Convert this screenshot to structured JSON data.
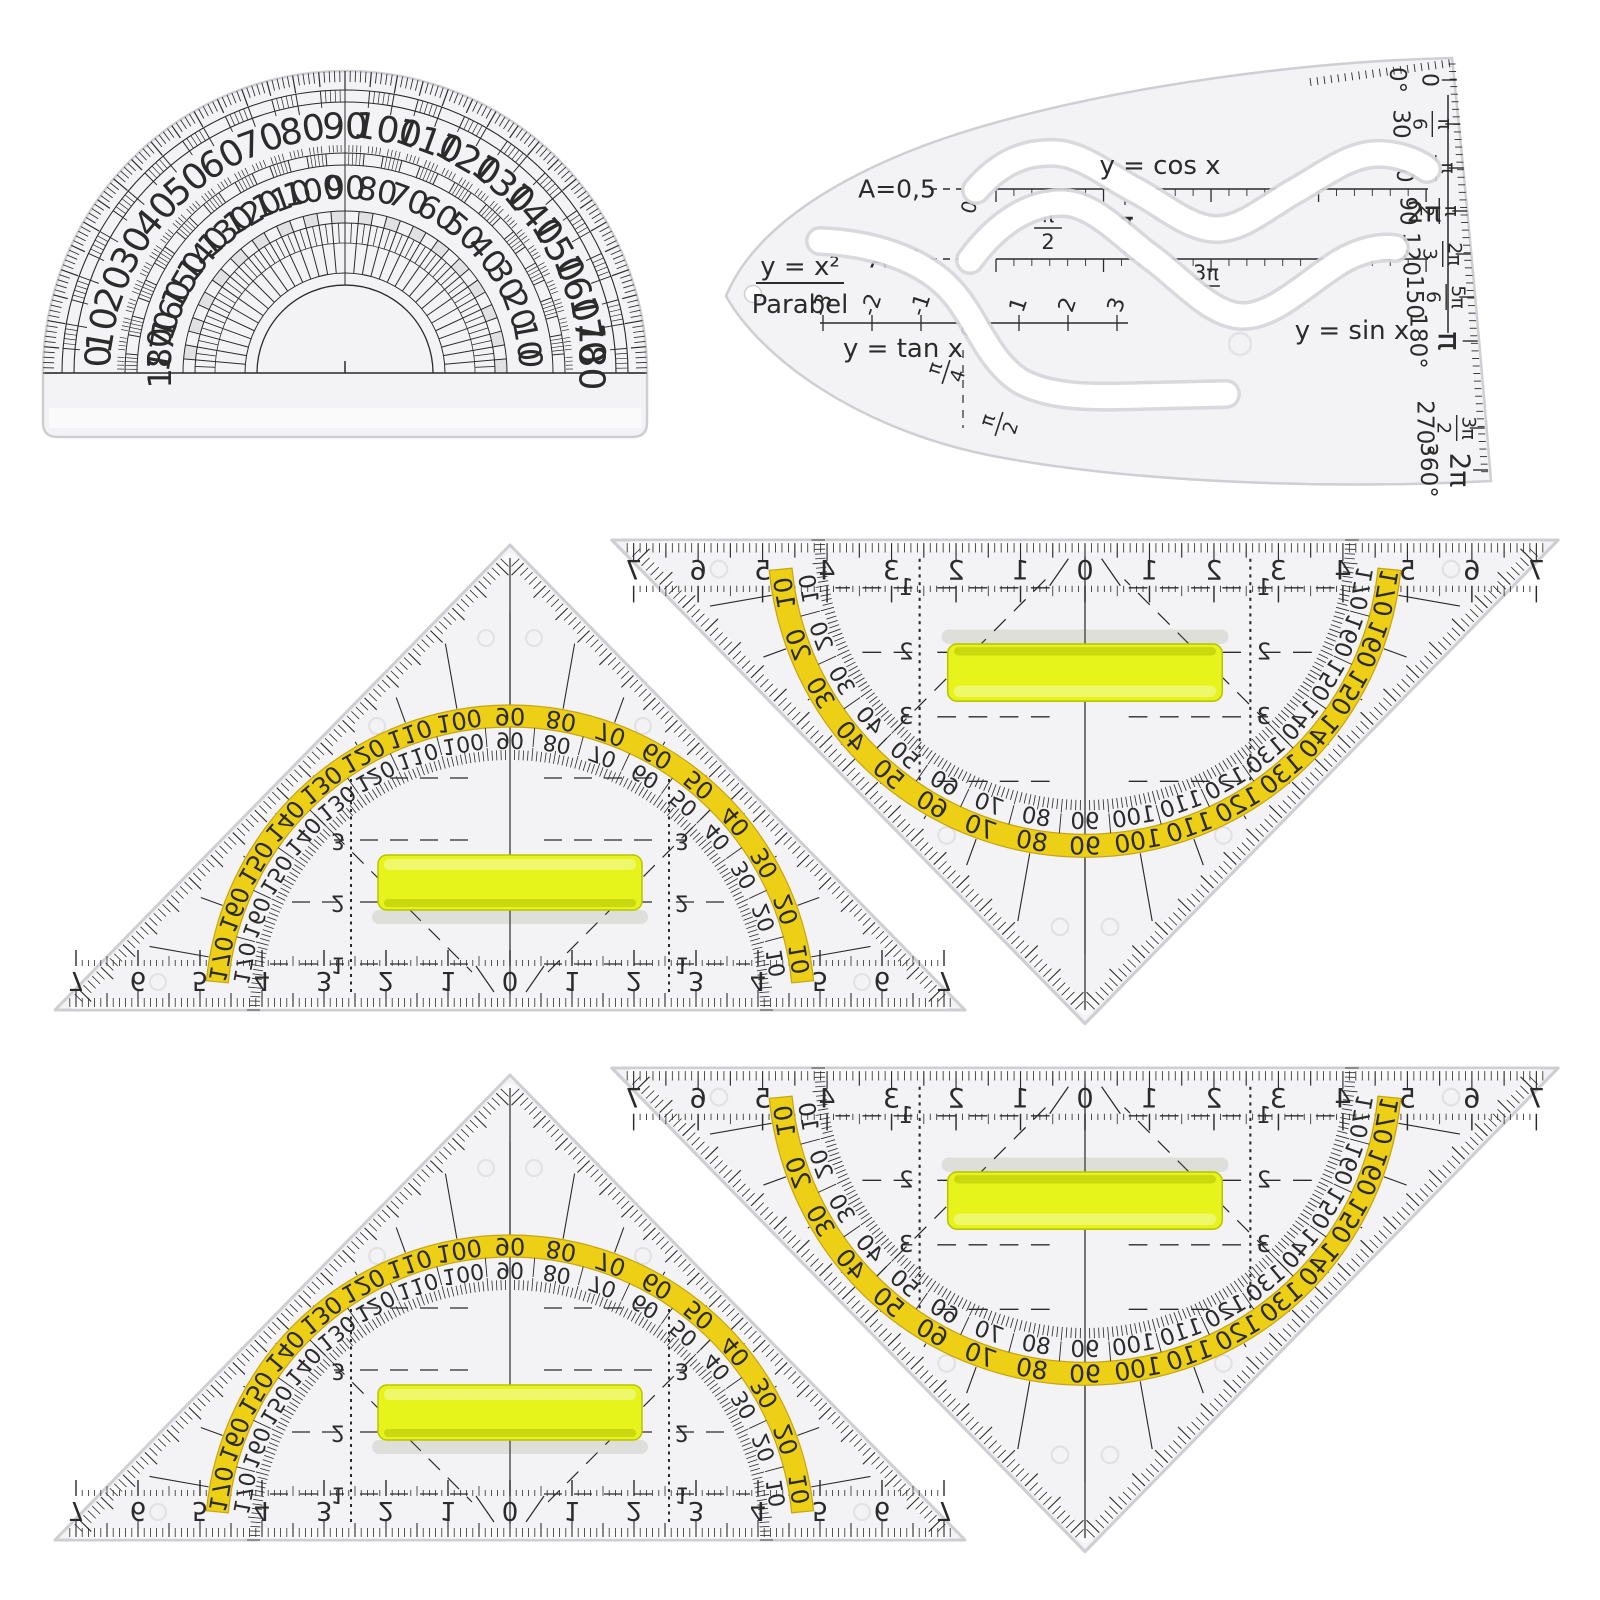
{
  "protractor": {
    "outer_scale": [
      "0",
      "10",
      "20",
      "30",
      "40",
      "50",
      "60",
      "70",
      "80",
      "90",
      "100",
      "110",
      "120",
      "130",
      "140",
      "150",
      "160",
      "170",
      "180"
    ],
    "inner_scale": [
      "180",
      "170",
      "160",
      "150",
      "140",
      "130",
      "120",
      "110",
      "100",
      "90",
      "80",
      "70",
      "60",
      "50",
      "40",
      "30",
      "20",
      "10",
      "0"
    ]
  },
  "trig_template": {
    "parabola": {
      "equation": "y = x²",
      "name": "Parabel"
    },
    "amplitude_labels": [
      "A=0,5",
      "A=1"
    ],
    "curve_labels": {
      "cos": "y = cos x",
      "sin": "y = sin x",
      "tan": "y = tan x"
    },
    "axis_zero": "0",
    "tan_axis_ticks": [
      "-3",
      "-2",
      "-1",
      "1",
      "2",
      "3"
    ],
    "pi_marks": {
      "half_pi": "π/2",
      "pi": "π",
      "three_half_pi": "3π/2",
      "two_pi": "2π",
      "quarter_pi": "π/4",
      "lower_half_pi": "π/2"
    },
    "edge_scale": {
      "degrees": [
        "0°",
        "30",
        "60",
        "90",
        "120",
        "150",
        "180°",
        "270°",
        "360°"
      ],
      "radians": [
        "0",
        "π/6",
        "π/3",
        "π/2",
        "2π/3",
        "5π/6",
        "π",
        "3π/2",
        "2π"
      ]
    }
  },
  "geo_triangle": {
    "cm_numbers": [
      "7",
      "6",
      "5",
      "4",
      "3",
      "2",
      "1",
      "0",
      "1",
      "2",
      "3",
      "4",
      "5",
      "6",
      "7"
    ],
    "protractor_outer": [
      "10",
      "20",
      "30",
      "40",
      "50",
      "60",
      "70",
      "80",
      "90",
      "100",
      "110",
      "120",
      "130",
      "140",
      "150",
      "160",
      "170"
    ],
    "protractor_inner": [
      "170",
      "160",
      "150",
      "140",
      "130",
      "120",
      "110",
      "100",
      "90",
      "80",
      "70",
      "60",
      "50",
      "40",
      "30",
      "20",
      "10"
    ],
    "grid_numbers": [
      "1",
      "2",
      "3"
    ]
  },
  "colors": {
    "plastic": "#f3f3f5",
    "plastic_light": "#fafafb",
    "edge": "#cfcfd3",
    "ink": "#2b2b2b",
    "band_yellow": "#edd016",
    "band_edge": "#c7a512",
    "handle_yellow": "#e7f41c",
    "handle_edge": "#b9c400",
    "slot_edge": "#d6d6da",
    "white": "#ffffff"
  }
}
